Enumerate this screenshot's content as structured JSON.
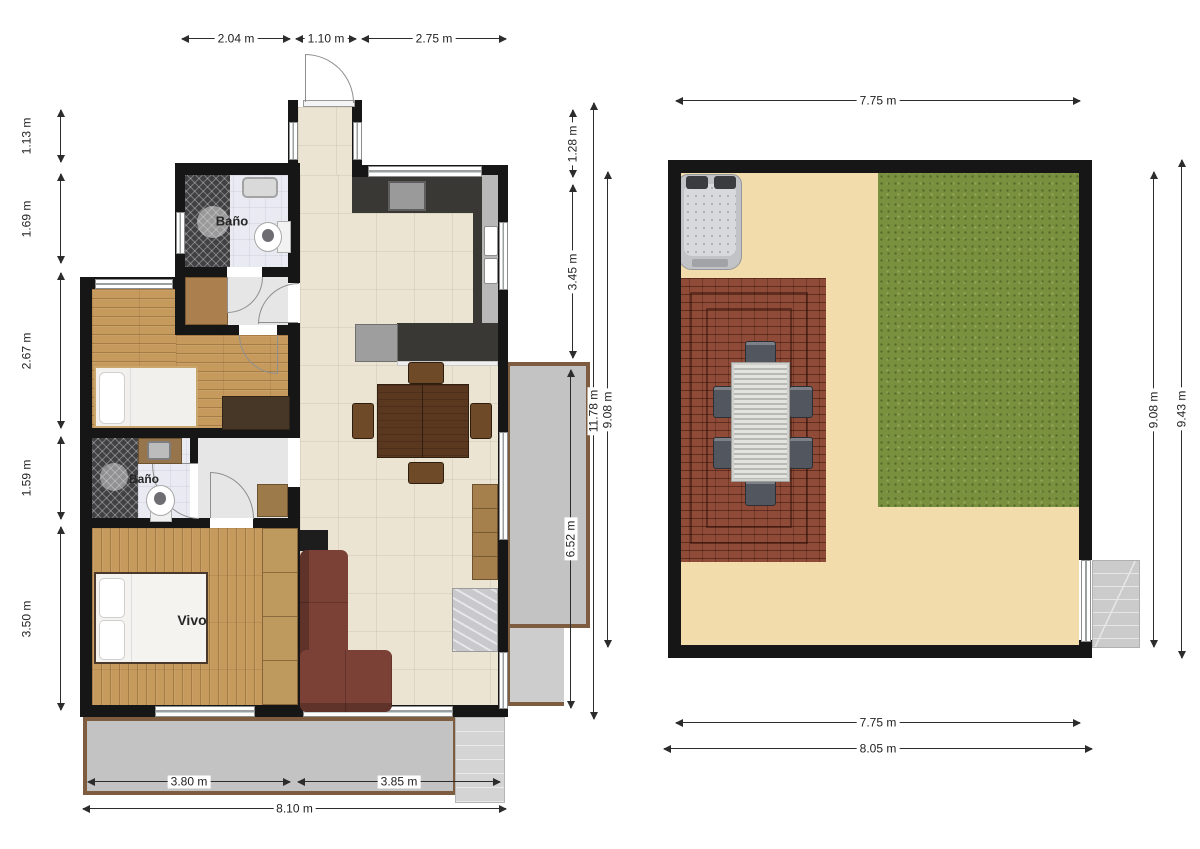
{
  "plan_left": {
    "dim_top_1": "2.04 m",
    "dim_top_2": "1.10 m",
    "dim_top_3": "2.75 m",
    "dim_left_1": "1.13 m",
    "dim_left_2": "1.69 m",
    "dim_left_3": "2.67 m",
    "dim_left_4": "1.59 m",
    "dim_left_5": "3.50 m",
    "dim_mid_1": "1.28 m",
    "dim_mid_2": "3.45 m",
    "dim_total_height": "11.78 m",
    "dim_inner_height": "9.08 m",
    "dim_balcony": "6.52 m",
    "dim_bottom_1": "3.80 m",
    "dim_bottom_2": "3.85 m",
    "dim_bottom_total": "8.10 m",
    "room_bath_top": "Baño",
    "room_bath_mid": "Baño",
    "room_bedroom": "Vivo"
  },
  "plan_right": {
    "dim_top": "7.75 m",
    "dim_right_1": "9.08 m",
    "dim_right_2": "9.43 m",
    "dim_bottom_1": "7.75 m",
    "dim_bottom_2": "8.05 m"
  },
  "palette": {
    "wall": "#161616",
    "wood_floor": "#c59a5c",
    "tile_floor": "#ece4d3",
    "balcony": "#c3c3c3",
    "balcony_border": "#7d5c3f",
    "sofa": "#7b4136",
    "grass": "#79903e",
    "brick_patio": "#8f4b37",
    "sand": "#f3dcab"
  }
}
